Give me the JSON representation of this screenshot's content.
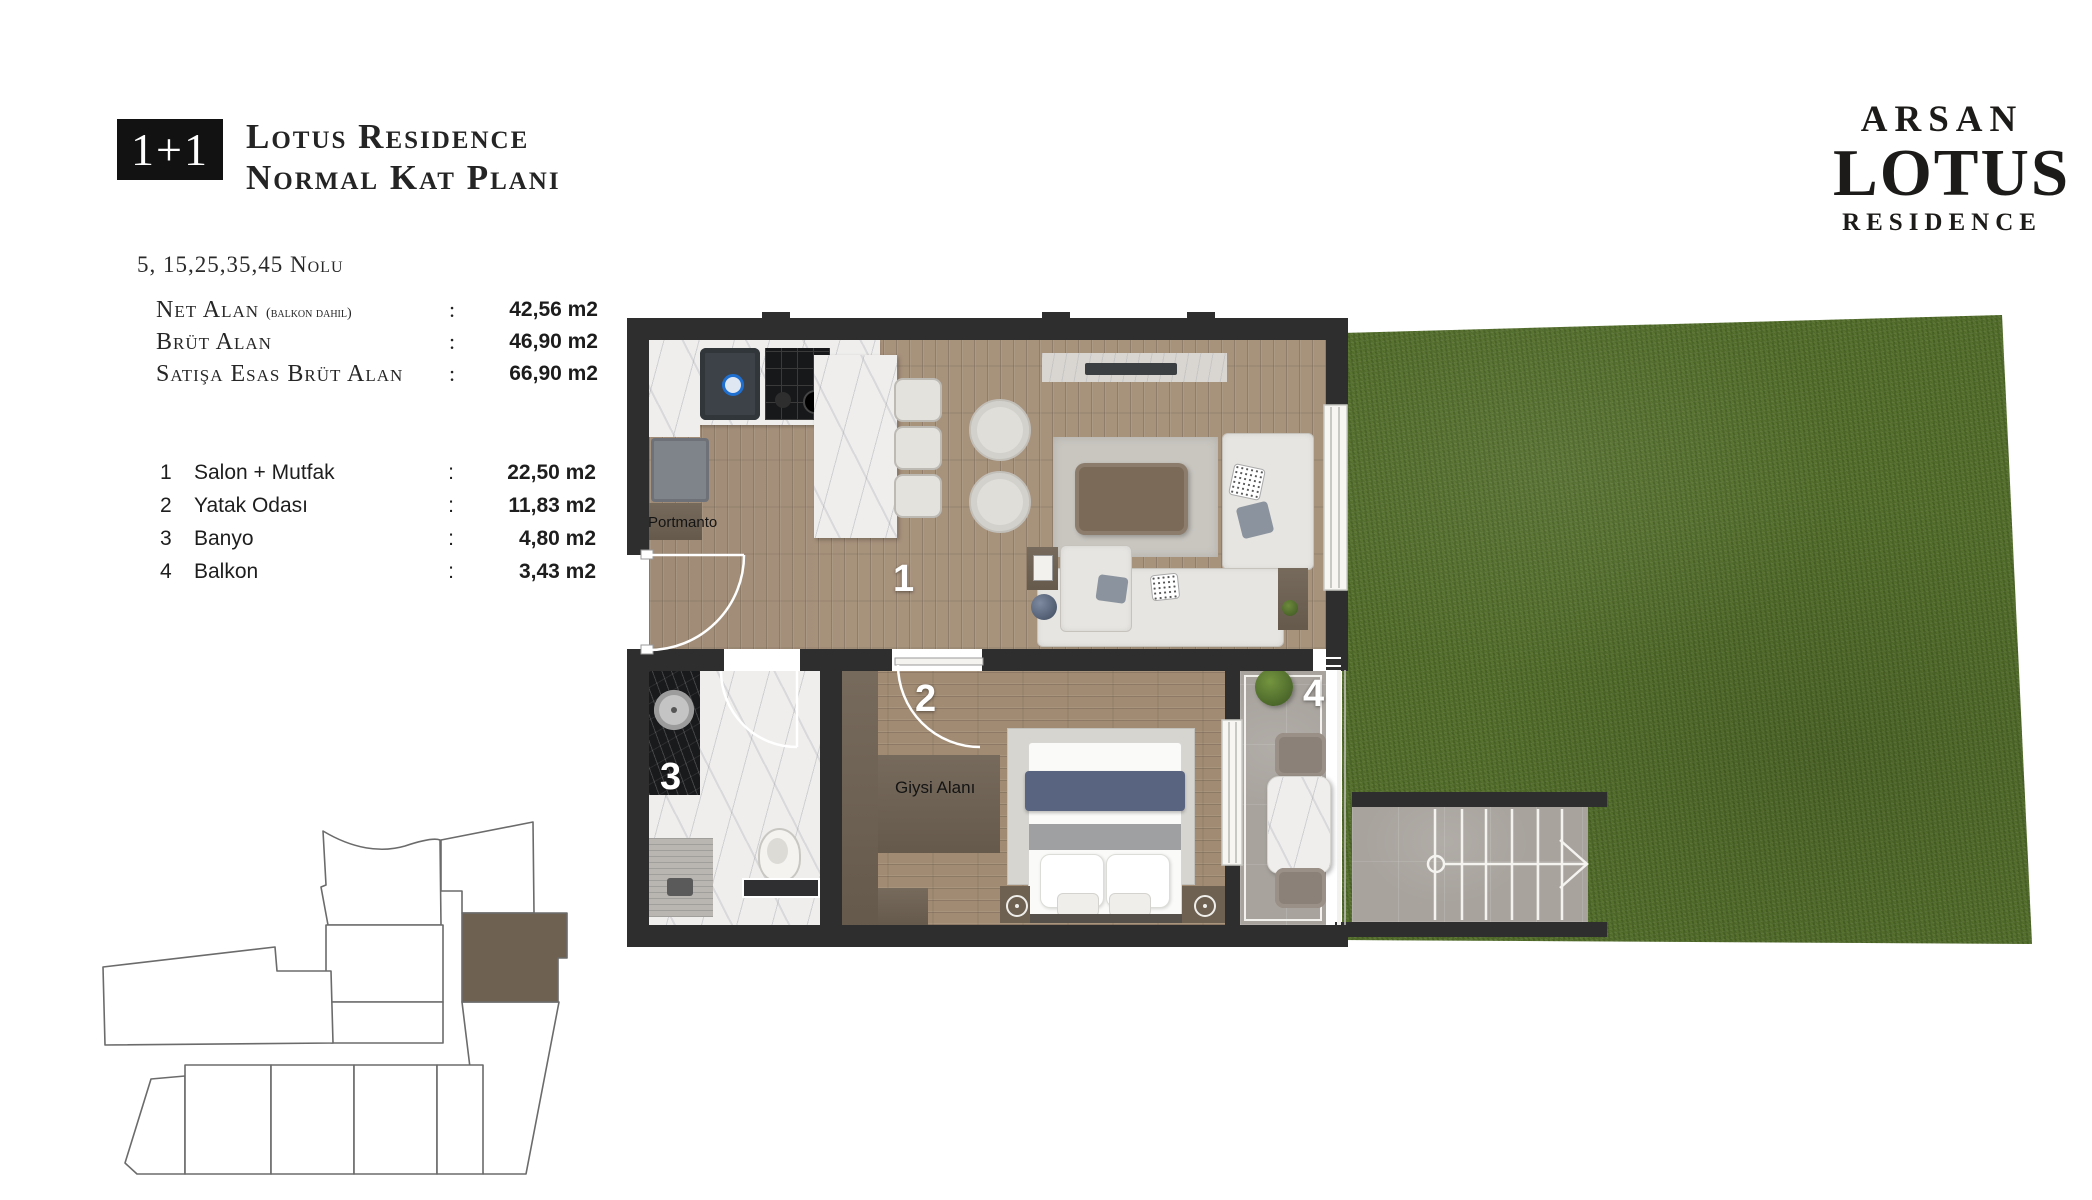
{
  "header": {
    "badge": "1+1",
    "title_line1": "Lotus Residence",
    "title_line2": "Normal Kat Planı",
    "unit_numbers": "5, 15,25,35,45 Nolu"
  },
  "area_table": {
    "colon": ":",
    "rows": [
      {
        "label": "Net Alan",
        "note": "(balkon dahil)",
        "value": "42,56 m2"
      },
      {
        "label": "Brüt Alan",
        "note": "",
        "value": "46,90 m2"
      },
      {
        "label": "Satışa Esas Brüt Alan",
        "note": "",
        "value": "66,90 m2"
      }
    ]
  },
  "room_table": {
    "colon": ":",
    "rows": [
      {
        "num": "1",
        "name": "Salon + Mutfak",
        "value": "22,50 m2"
      },
      {
        "num": "2",
        "name": "Yatak Odası",
        "value": "11,83 m2"
      },
      {
        "num": "3",
        "name": "Banyo",
        "value": "4,80 m2"
      },
      {
        "num": "4",
        "name": "Balkon",
        "value": "3,43 m2"
      }
    ]
  },
  "logo": {
    "line1": "ARSAN",
    "line2": "LOTUS",
    "line3": "RESIDENCE"
  },
  "floor_plan": {
    "labels": {
      "room1": "1",
      "room2": "2",
      "room3": "3",
      "room4": "4",
      "portmanto": "Portmanto",
      "giysi_alani": "Giysi Alanı"
    }
  },
  "colors": {
    "wall": "#2e2e2e",
    "wood": "#a7927c",
    "lawn_green": "#57722e",
    "marble_white": "#efeeec",
    "black_marble": "#191a1c",
    "furniture_brown": "#6e6152",
    "balcony_stone": "#a8a39d",
    "bed_runner_navy": "#596480",
    "badge_black": "#121212"
  }
}
